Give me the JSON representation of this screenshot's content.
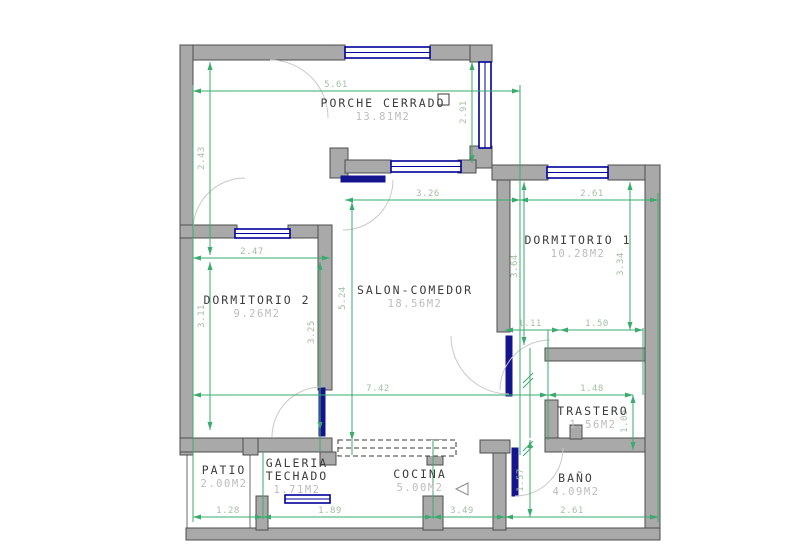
{
  "drawing": {
    "type": "architectural-floor-plan",
    "units": "M2"
  },
  "colors": {
    "wall_fill": "#a9a9a9",
    "wall_stroke": "#4d4d4d",
    "window_blue": "#00009a",
    "door_leaf_blue": "#14148c",
    "dimension_green": "#3aab6e",
    "dimension_text": "#a3bfa3",
    "room_name_text": "#3c3c3c",
    "room_area_text": "#bcbcbc"
  },
  "rooms": [
    {
      "name": "PORCHE CERRADO",
      "area": "13.81M2",
      "x": 383,
      "y": 107
    },
    {
      "name": "DORMITORIO 1",
      "area": "10.28M2",
      "x": 578,
      "y": 244
    },
    {
      "name": "DORMITORIO 2",
      "area": "9.26M2",
      "x": 257,
      "y": 304
    },
    {
      "name": "SALON-COMEDOR",
      "area": "18.56M2",
      "x": 415,
      "y": 294
    },
    {
      "name": "TRASTERO",
      "area": "1.56M2",
      "x": 593,
      "y": 415
    },
    {
      "name": "PATIO",
      "area": "2.00M2",
      "x": 224,
      "y": 474
    },
    {
      "name": "GALERIA",
      "name2": "TECHADO",
      "area": "1.71M2",
      "x": 297,
      "y": 467
    },
    {
      "name": "COCINA",
      "area": "5.00M2",
      "x": 420,
      "y": 478
    },
    {
      "name": "BAÑO",
      "area": "4.09M2",
      "x": 576,
      "y": 482
    }
  ],
  "dimensions": {
    "horizontal": [
      {
        "value": "5.61",
        "x1": 193,
        "x2": 520,
        "y": 91,
        "lx": 336,
        "ly": 87
      },
      {
        "value": "3.26",
        "x1": 345,
        "x2": 520,
        "y": 200,
        "lx": 428,
        "ly": 196
      },
      {
        "value": "2.61",
        "x1": 520,
        "x2": 658,
        "y": 200,
        "lx": 592,
        "ly": 196
      },
      {
        "value": "2.47",
        "x1": 193,
        "x2": 330,
        "y": 258,
        "lx": 252,
        "ly": 254
      },
      {
        "value": "1.11",
        "x1": 505,
        "x2": 560,
        "y": 330,
        "lx": 530,
        "ly": 326
      },
      {
        "value": "1.50",
        "x1": 560,
        "x2": 643,
        "y": 330,
        "lx": 597,
        "ly": 326
      },
      {
        "value": "7.42",
        "x1": 193,
        "x2": 548,
        "y": 395,
        "lx": 378,
        "ly": 391
      },
      {
        "value": "1.48",
        "x1": 548,
        "x2": 633,
        "y": 395,
        "lx": 592,
        "ly": 391
      },
      {
        "value": "1.28",
        "x1": 193,
        "x2": 263,
        "y": 517,
        "lx": 228,
        "ly": 513
      },
      {
        "value": "1.89",
        "x1": 263,
        "x2": 433,
        "y": 517,
        "lx": 330,
        "ly": 513
      },
      {
        "value": "3.49",
        "x1": 433,
        "x2": 505,
        "y": 517,
        "lx": 462,
        "ly": 513
      },
      {
        "value": "2.61",
        "x1": 505,
        "x2": 658,
        "y": 517,
        "lx": 572,
        "ly": 513
      }
    ],
    "vertical": [
      {
        "value": "2.43",
        "x": 210,
        "y1": 62,
        "y2": 255,
        "lx": 204,
        "ly": 158
      },
      {
        "value": "2.91",
        "x": 472,
        "y1": 62,
        "y2": 163,
        "lx": 466,
        "ly": 112
      },
      {
        "value": "3.11",
        "x": 210,
        "y1": 262,
        "y2": 430,
        "lx": 204,
        "ly": 316
      },
      {
        "value": "3.25",
        "x": 320,
        "y1": 262,
        "y2": 430,
        "lx": 314,
        "ly": 332
      },
      {
        "value": "5.24",
        "x": 352,
        "y1": 202,
        "y2": 440,
        "lx": 345,
        "ly": 298
      },
      {
        "value": "3.64",
        "x": 524,
        "y1": 182,
        "y2": 345,
        "lx": 517,
        "ly": 266
      },
      {
        "value": "3.34",
        "x": 630,
        "y1": 182,
        "y2": 330,
        "lx": 623,
        "ly": 264
      },
      {
        "value": "1.05",
        "x": 633,
        "y1": 395,
        "y2": 450,
        "lx": 627,
        "ly": 421
      },
      {
        "value": "1.57",
        "x": 530,
        "y1": 440,
        "y2": 517,
        "lx": 523,
        "ly": 480
      }
    ],
    "extension_lines": [
      {
        "x1": 193,
        "y1": 85,
        "x2": 193,
        "y2": 522
      },
      {
        "x1": 520,
        "y1": 85,
        "x2": 520,
        "y2": 455
      },
      {
        "x1": 658,
        "y1": 193,
        "x2": 658,
        "y2": 522
      },
      {
        "x1": 320,
        "y1": 430,
        "x2": 320,
        "y2": 452
      },
      {
        "x1": 352,
        "y1": 440,
        "x2": 352,
        "y2": 455
      },
      {
        "x1": 263,
        "y1": 452,
        "x2": 263,
        "y2": 519
      },
      {
        "x1": 433,
        "y1": 440,
        "x2": 433,
        "y2": 519
      },
      {
        "x1": 548,
        "y1": 330,
        "x2": 548,
        "y2": 440
      },
      {
        "x1": 643,
        "y1": 328,
        "x2": 643,
        "y2": 395
      },
      {
        "x1": 530,
        "y1": 348,
        "x2": 530,
        "y2": 438
      }
    ]
  }
}
